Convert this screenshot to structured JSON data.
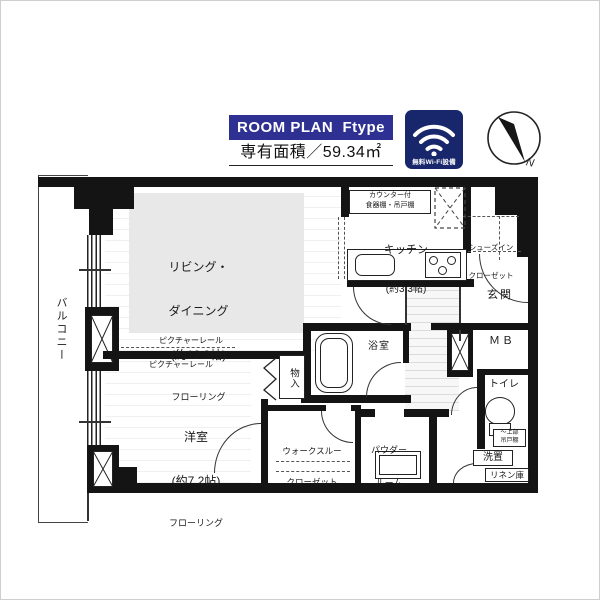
{
  "header": {
    "plan_label": "ROOM PLAN  Ftype",
    "area_label": "専有面積／59.34㎡",
    "wifi_label": "無料Wi-Fi設備",
    "compass_n": "N"
  },
  "colors": {
    "plan_box_bg": "#2e3192",
    "wifi_box_bg": "#18266b",
    "wall": "#141414",
    "living_shade": "#e8e8e8"
  },
  "rooms": {
    "balcony": "バルコニー",
    "living": [
      "リビング・",
      "ダイニング",
      "(約12.3帖)",
      "フローリング"
    ],
    "kitchen_name": "キッチン",
    "kitchen_size": "(約3.3帖)",
    "counter_l1": "カウンター付",
    "counter_l2": "食器棚・吊戸棚",
    "sic_l1": "シューズイン",
    "sic_l2": "クローゼット",
    "entrance": "玄関",
    "mb": "ＭＢ",
    "toilet": "トイレ",
    "upper_l1": "〜上部",
    "upper_l2": "吊戸棚",
    "laundry": "洗置",
    "linen": "リネン庫",
    "bath": "浴室",
    "powder_l1": "パウダー",
    "powder_l2": "ルーム",
    "wtc_l1": "ウォークスルー",
    "wtc_l2": "クローゼット",
    "storage": "物入",
    "bedroom_name": "洋室",
    "bedroom_size": "(約7.2帖)",
    "bedroom_floor": "フローリング",
    "rail1": "ピクチャーレール",
    "rail2": "ピクチャーレール"
  }
}
